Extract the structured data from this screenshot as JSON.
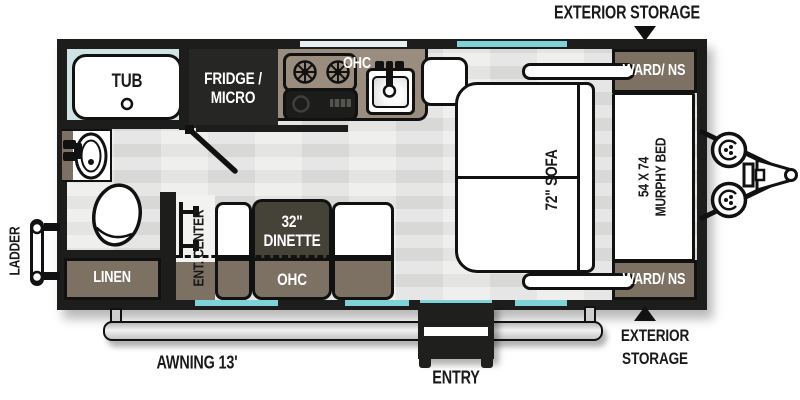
{
  "floorplan": {
    "exterior": {
      "storage_top": "EXTERIOR STORAGE",
      "storage_bottom_line1": "EXTERIOR",
      "storage_bottom_line2": "STORAGE",
      "awning": "AWNING 13'",
      "entry": "ENTRY",
      "ladder": "LADDER"
    },
    "rooms": {
      "tub": "TUB",
      "fridge_micro_line1": "FRIDGE /",
      "fridge_micro_line2": "MICRO",
      "kitchen_ohc": "OHC",
      "linen": "LINEN",
      "ent_center": "ENT. CENTER",
      "dinette_size": "32\"",
      "dinette_name": "DINETTE",
      "dinette_ohc": "OHC",
      "sofa": "72\" SOFA",
      "murphy_bed_size": "54 X 74",
      "murphy_bed_name": "MURPHY BED",
      "wardrobe_top": "WARD/ NS",
      "wardrobe_bottom": "WARD/ NS"
    },
    "colors": {
      "wall": "#1d1d1b",
      "floor": "#e4e4e3",
      "bath_floor": "#cfe2e4",
      "cabinet_taupe": "#7c7163",
      "counter_taupe": "#9a8d80",
      "dark_fixture": "#262624",
      "dinette_table": "#454238",
      "window_teal": "#7fd3d8",
      "window_pale": "#e8eff0",
      "awning_grey": "#d6d6d6"
    }
  }
}
